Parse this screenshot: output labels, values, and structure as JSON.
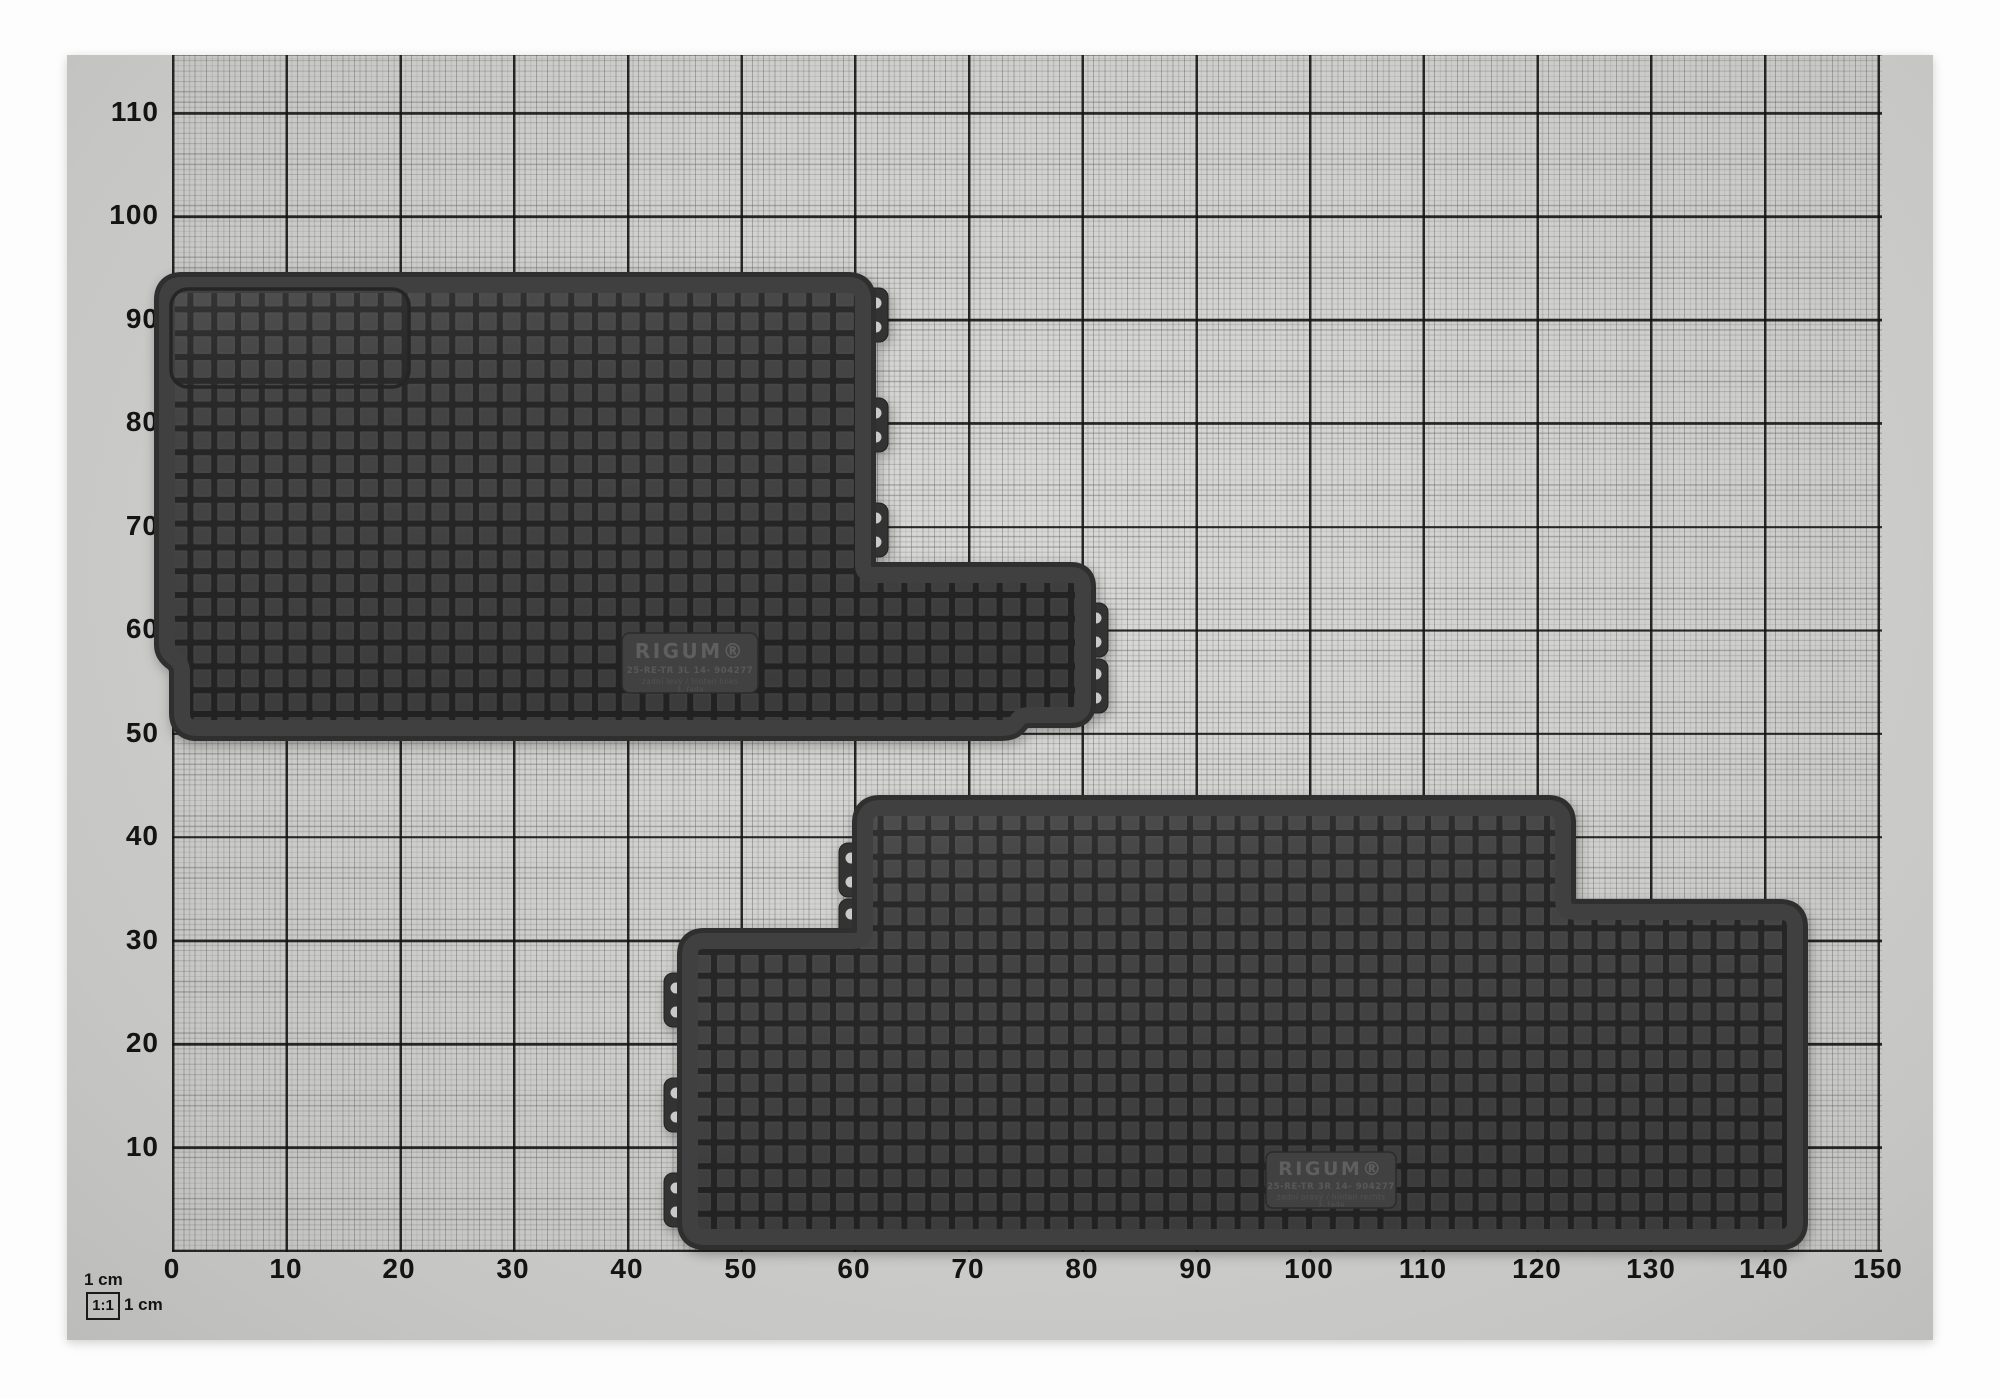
{
  "axes": {
    "left": [
      "110",
      "100",
      "90",
      "80",
      "70",
      "60",
      "50",
      "40",
      "30",
      "20",
      "10"
    ],
    "bottom": [
      "0",
      "10",
      "20",
      "30",
      "40",
      "50",
      "60",
      "70",
      "80",
      "90",
      "100",
      "110",
      "120",
      "130",
      "140",
      "150"
    ]
  },
  "legend": {
    "unit_label": "1 cm",
    "scale_ratio": "1:1",
    "scale_unit": "1 cm"
  },
  "mats": {
    "left": {
      "brand": "RIGUM®",
      "code": "25-RE-TR 3L 14- 904277",
      "position_line": "zadní levý / hinten links",
      "row_line": "3. řada"
    },
    "right": {
      "brand": "RIGUM®",
      "code": "25-RE-TR 3R 14- 904277",
      "position_line": "zadní pravý / hinten rechts",
      "row_line": "3. řada"
    }
  },
  "colors": {
    "paper": "#d1d1cf",
    "grid_major": "#1c1c1c",
    "mat_rim": "#2f2f2f",
    "mat_band": "#404040",
    "mat_cell": "#464646",
    "mat_groove": "#262626",
    "plate": "#414141"
  }
}
